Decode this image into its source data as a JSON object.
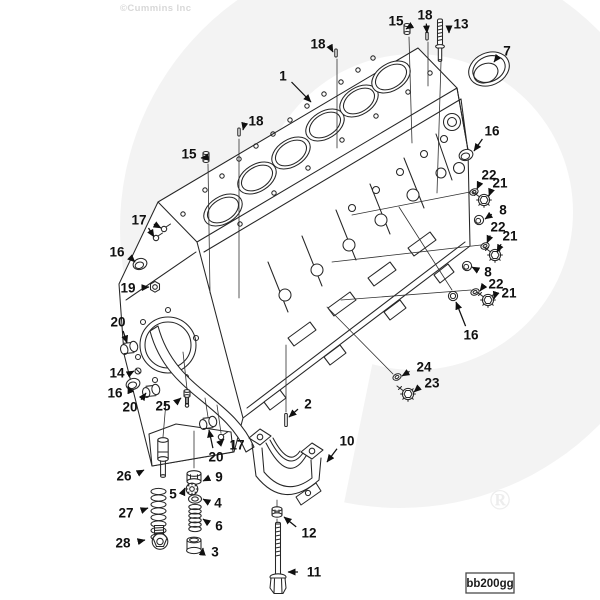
{
  "watermark": {
    "copyright": "©Cummins Inc",
    "registered": "®"
  },
  "footer": {
    "code": "bb200gg"
  },
  "colors": {
    "background": "#ffffff",
    "line_ink": "#262626",
    "callout_ink": "#101010",
    "watermark_fill": "#f3f3f3",
    "watermark_text": "#d8d8d8",
    "registered_mark": "#ededed"
  },
  "diagram": {
    "type": "exploded-parts-diagram",
    "callouts": [
      {
        "label": "1",
        "x": 283,
        "y": 76,
        "tips": [
          [
            311,
            102
          ]
        ]
      },
      {
        "label": "18",
        "x": 318,
        "y": 44,
        "tips": [
          [
            333,
            52
          ]
        ]
      },
      {
        "label": "15",
        "x": 396,
        "y": 21,
        "tips": [
          [
            406,
            29
          ]
        ]
      },
      {
        "label": "18",
        "x": 425,
        "y": 15,
        "tips": [
          [
            427,
            33
          ]
        ]
      },
      {
        "label": "13",
        "x": 461,
        "y": 24,
        "tips": [
          [
            449,
            33
          ]
        ]
      },
      {
        "label": "7",
        "x": 507,
        "y": 51,
        "tips": [
          [
            494,
            62
          ]
        ]
      },
      {
        "label": "16",
        "x": 492,
        "y": 131,
        "tips": [
          [
            474,
            151
          ]
        ]
      },
      {
        "label": "18",
        "x": 256,
        "y": 121,
        "tips": [
          [
            243,
            130
          ]
        ]
      },
      {
        "label": "15",
        "x": 189,
        "y": 154,
        "tips": [
          [
            201,
            158
          ]
        ]
      },
      {
        "label": "22",
        "x": 489,
        "y": 175,
        "tips": [
          [
            477,
            189
          ]
        ]
      },
      {
        "label": "21",
        "x": 500,
        "y": 183,
        "tips": [
          [
            489,
            196
          ]
        ]
      },
      {
        "label": "8",
        "x": 503,
        "y": 210,
        "tips": [
          [
            485,
            219
          ]
        ]
      },
      {
        "label": "22",
        "x": 498,
        "y": 227,
        "tips": [
          [
            487,
            243
          ]
        ]
      },
      {
        "label": "21",
        "x": 510,
        "y": 236,
        "tips": [
          [
            497,
            252
          ]
        ]
      },
      {
        "label": "17",
        "x": 139,
        "y": 220,
        "tips": [
          [
            161,
            228
          ],
          [
            154,
            237
          ]
        ]
      },
      {
        "label": "16",
        "x": 117,
        "y": 252,
        "tips": [
          [
            135,
            262
          ]
        ]
      },
      {
        "label": "19",
        "x": 128,
        "y": 288,
        "tips": [
          [
            149,
            287
          ]
        ]
      },
      {
        "label": "8",
        "x": 488,
        "y": 272,
        "tips": [
          [
            472,
            267
          ]
        ]
      },
      {
        "label": "22",
        "x": 496,
        "y": 284,
        "tips": [
          [
            480,
            291
          ]
        ]
      },
      {
        "label": "21",
        "x": 509,
        "y": 293,
        "tips": [
          [
            494,
            299
          ]
        ]
      },
      {
        "label": "20",
        "x": 118,
        "y": 322,
        "tips": [
          [
            127,
            343
          ]
        ]
      },
      {
        "label": "16",
        "x": 471,
        "y": 335,
        "tips": [
          [
            456,
            302
          ]
        ]
      },
      {
        "label": "24",
        "x": 424,
        "y": 367,
        "tips": [
          [
            402,
            376
          ]
        ]
      },
      {
        "label": "23",
        "x": 432,
        "y": 383,
        "tips": [
          [
            414,
            392
          ]
        ]
      },
      {
        "label": "14",
        "x": 117,
        "y": 373,
        "tips": [
          [
            134,
            371
          ]
        ]
      },
      {
        "label": "16",
        "x": 115,
        "y": 393,
        "tips": [
          [
            128,
            386
          ]
        ]
      },
      {
        "label": "20",
        "x": 130,
        "y": 407,
        "tips": [
          [
            146,
            393
          ]
        ]
      },
      {
        "label": "25",
        "x": 163,
        "y": 406,
        "tips": [
          [
            181,
            398
          ]
        ]
      },
      {
        "label": "20",
        "x": 216,
        "y": 457,
        "tips": [
          [
            209,
            430
          ]
        ]
      },
      {
        "label": "17",
        "x": 237,
        "y": 445,
        "tips": [
          [
            224,
            439
          ]
        ]
      },
      {
        "label": "2",
        "x": 308,
        "y": 404,
        "tips": [
          [
            289,
            417
          ]
        ]
      },
      {
        "label": "10",
        "x": 347,
        "y": 441,
        "tips": [
          [
            327,
            462
          ]
        ]
      },
      {
        "label": "26",
        "x": 124,
        "y": 476,
        "tips": [
          [
            144,
            470
          ]
        ]
      },
      {
        "label": "9",
        "x": 219,
        "y": 477,
        "tips": [
          [
            203,
            481
          ]
        ]
      },
      {
        "label": "5",
        "x": 173,
        "y": 494,
        "tips": [
          [
            185,
            488
          ]
        ]
      },
      {
        "label": "4",
        "x": 218,
        "y": 503,
        "tips": [
          [
            203,
            499
          ]
        ]
      },
      {
        "label": "27",
        "x": 126,
        "y": 513,
        "tips": [
          [
            148,
            508
          ]
        ]
      },
      {
        "label": "6",
        "x": 219,
        "y": 526,
        "tips": [
          [
            203,
            519
          ]
        ]
      },
      {
        "label": "28",
        "x": 123,
        "y": 543,
        "tips": [
          [
            145,
            540
          ]
        ]
      },
      {
        "label": "3",
        "x": 215,
        "y": 552,
        "tips": [
          [
            203,
            548
          ]
        ]
      },
      {
        "label": "12",
        "x": 309,
        "y": 533,
        "tips": [
          [
            284,
            517
          ]
        ]
      },
      {
        "label": "11",
        "x": 314,
        "y": 572,
        "tips": [
          [
            288,
            572
          ]
        ]
      }
    ]
  }
}
